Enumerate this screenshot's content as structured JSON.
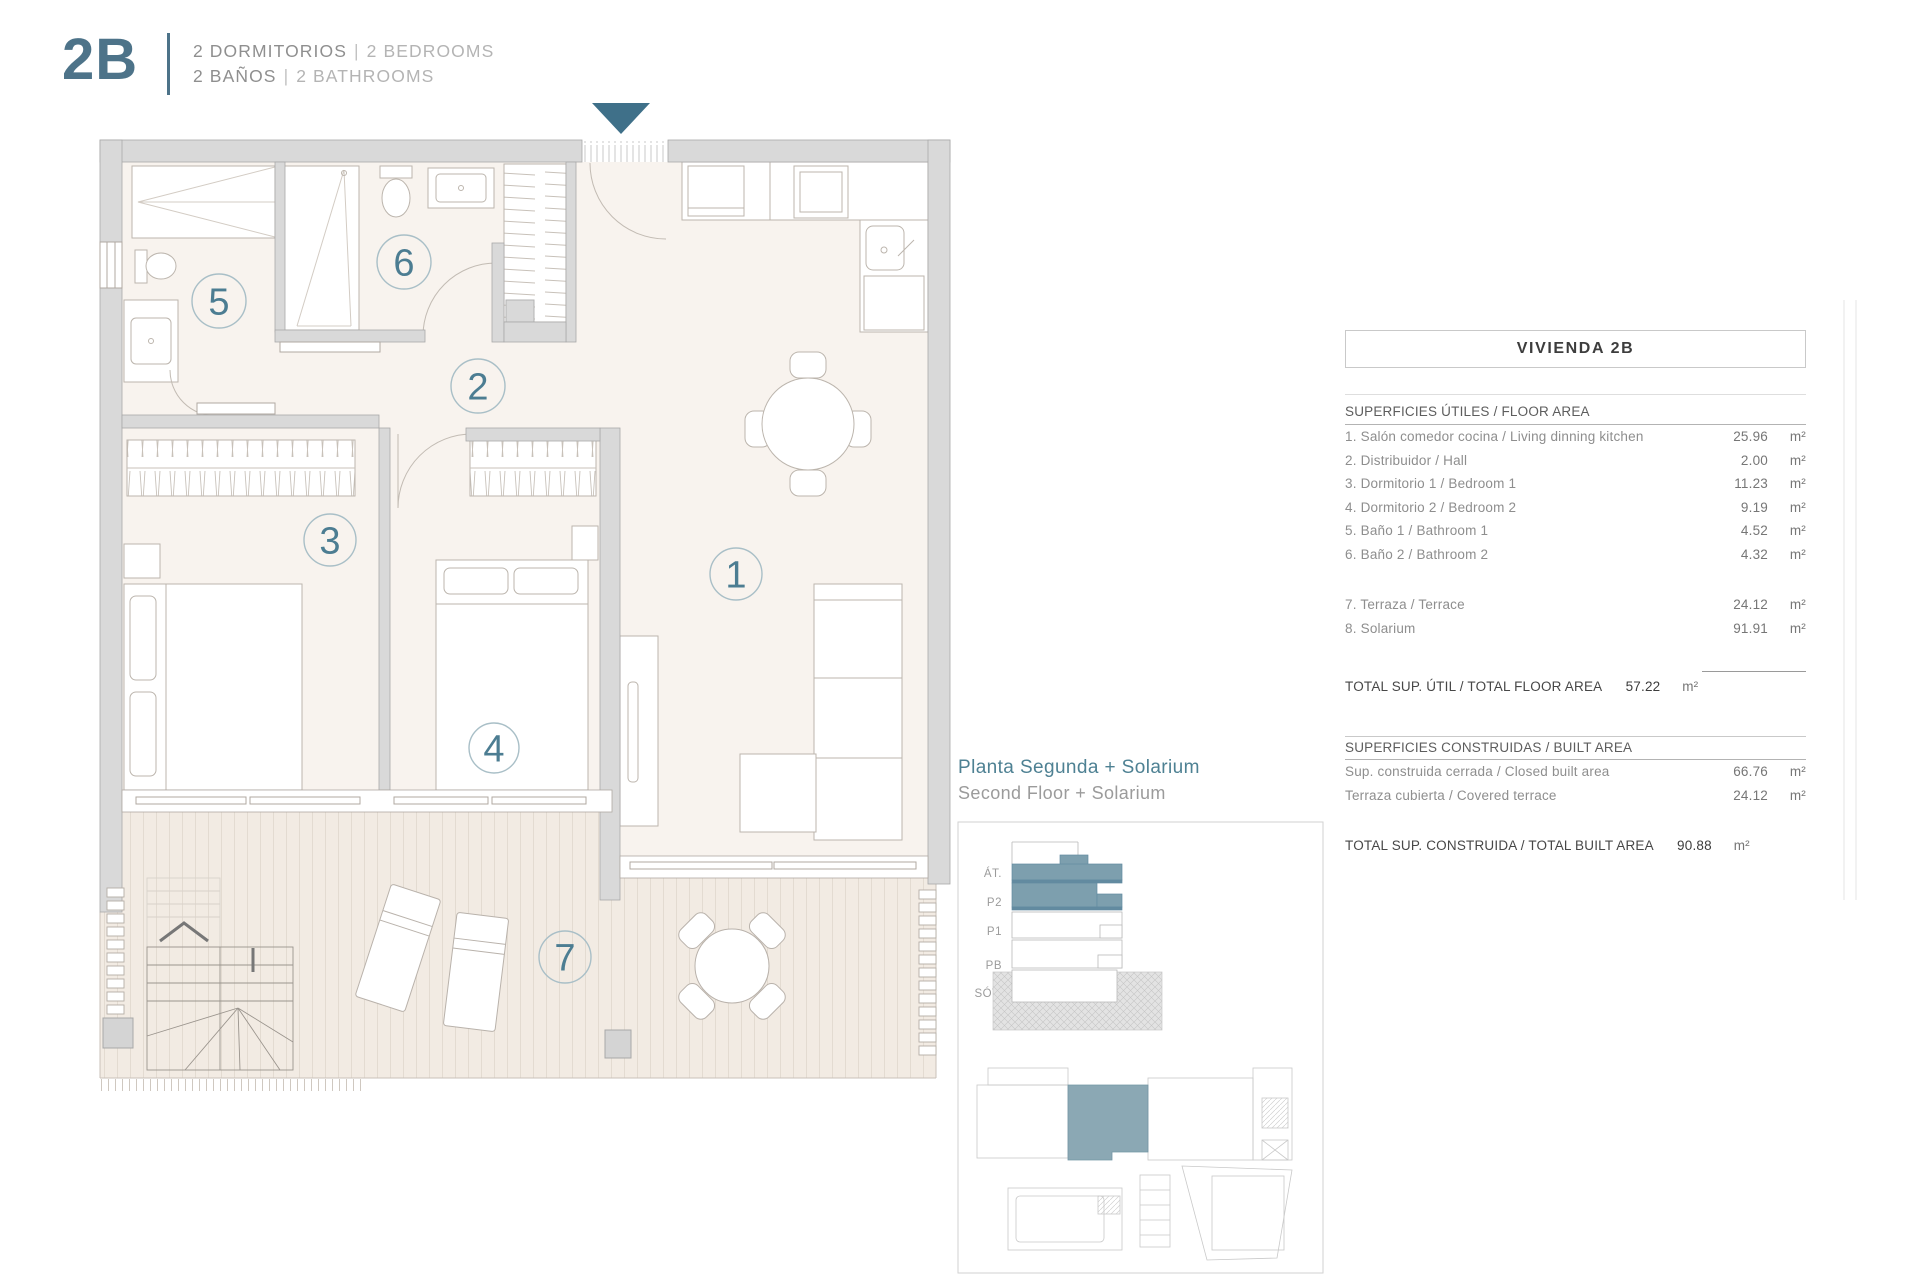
{
  "header": {
    "unit_name": "2B",
    "separator": "|",
    "rooms_line": {
      "es": "2 DORMITORIOS",
      "en": "2 BEDROOMS"
    },
    "baths_line": {
      "es": "2 BAÑOS",
      "en": "2 BATHROOMS"
    }
  },
  "plan": {
    "rooms": [
      {
        "number": "1"
      },
      {
        "number": "2"
      },
      {
        "number": "3"
      },
      {
        "number": "4"
      },
      {
        "number": "5"
      },
      {
        "number": "6"
      },
      {
        "number": "7"
      }
    ],
    "icons": {
      "entrance": "entrance-arrow-down"
    }
  },
  "panel": {
    "title": "VIVIENDA 2B",
    "floor_area": {
      "heading": "SUPERFICIES ÚTILES / FLOOR AREA",
      "rows": [
        {
          "label": "1. Salón comedor cocina / Living dinning kitchen",
          "value": "25.96",
          "unit": "m²"
        },
        {
          "label": "2. Distribuidor / Hall",
          "value": "2.00",
          "unit": "m²"
        },
        {
          "label": "3. Dormitorio 1 / Bedroom 1",
          "value": "11.23",
          "unit": "m²"
        },
        {
          "label": "4. Dormitorio 2 / Bedroom 2",
          "value": "9.19",
          "unit": "m²"
        },
        {
          "label": "5. Baño 1 / Bathroom 1",
          "value": "4.52",
          "unit": "m²"
        },
        {
          "label": "6. Baño 2 / Bathroom 2",
          "value": "4.32",
          "unit": "m²"
        },
        {
          "label": "7. Terraza / Terrace",
          "value": "24.12",
          "unit": "m²"
        },
        {
          "label": "8. Solarium",
          "value": "91.91",
          "unit": "m²"
        }
      ],
      "total_label": "TOTAL SUP. ÚTIL / TOTAL FLOOR AREA",
      "total_value": "57.22",
      "total_unit": "m²"
    },
    "built_area": {
      "heading": "SUPERFICIES CONSTRUIDAS / BUILT AREA",
      "rows": [
        {
          "label": "Sup. construida cerrada / Closed built area",
          "value": "66.76",
          "unit": "m²"
        },
        {
          "label": "Terraza cubierta / Covered terrace",
          "value": "24.12",
          "unit": "m²"
        }
      ],
      "total_label": "TOTAL SUP. CONSTRUIDA /  TOTAL BUILT AREA",
      "total_value": "90.88",
      "total_unit": "m²"
    }
  },
  "location": {
    "title_es": "Planta Segunda + Solarium",
    "title_en": "Second Floor + Solarium",
    "floors": [
      "ÁT.",
      "P2",
      "P1",
      "PB",
      "SÓT."
    ]
  },
  "colors": {
    "accent_teal": "#4D7389",
    "arrow_teal": "#3F7089",
    "section_highlight": "#7D9FAE",
    "site_highlight": "#8BA8B4",
    "wall_gray": "#D9D9D9"
  }
}
